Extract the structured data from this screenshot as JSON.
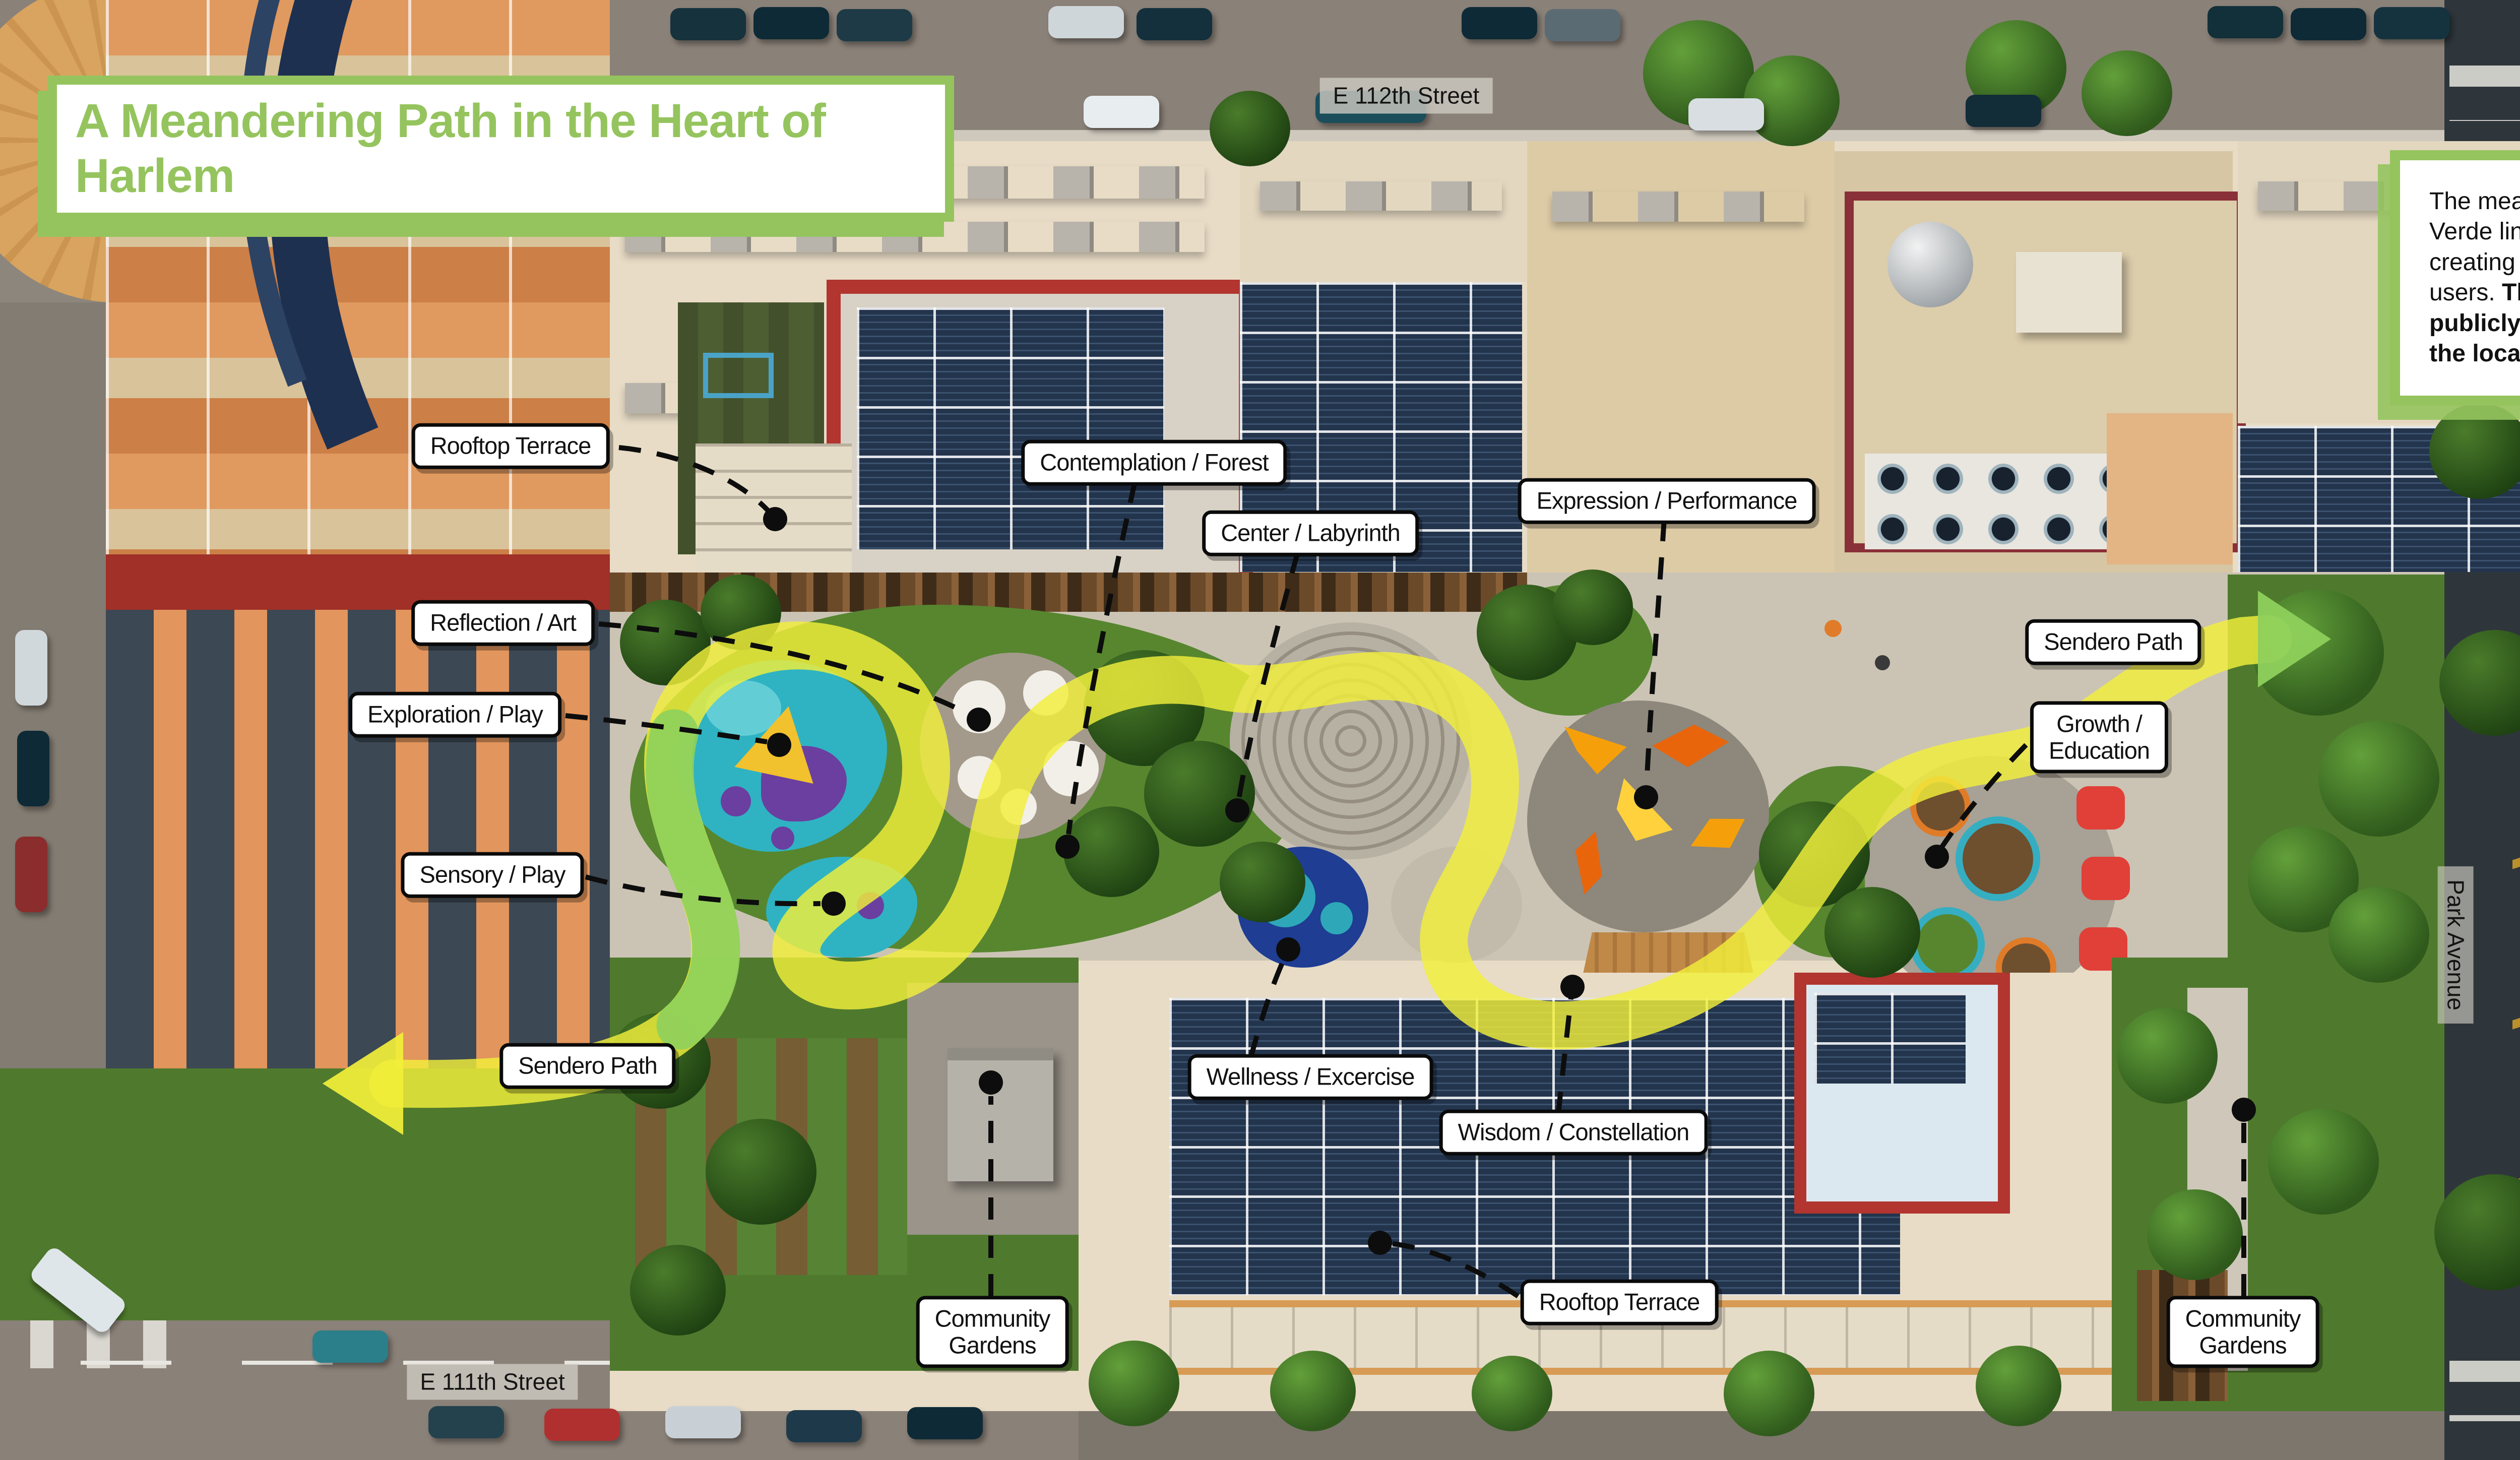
{
  "colors": {
    "accent_green": "#95c45e",
    "path_yellow": "#f2ef3a",
    "path_green": "#8ed05c",
    "label_border": "#0a0a0a"
  },
  "title": {
    "text": "A Meandering Path in the Heart of Harlem"
  },
  "description": {
    "intro": "The meandering pathway of Sendero Verde links diverse program features, creating spaces that cater to all types of users. ",
    "bold": "The elevated courtyard is publicly accessible for residents and the local community year-round!"
  },
  "streets": {
    "top": "E 112th Street",
    "bottom": "E 111th Street",
    "park_avenue": "Park Avenue",
    "railroad": "Long Island\nRail Road"
  },
  "compass": {
    "north_label": "N"
  },
  "feature_labels": [
    {
      "id": "rooftop-terrace-top",
      "text": "Rooftop Terrace"
    },
    {
      "id": "contemplation-forest",
      "text": "Contemplation / Forest"
    },
    {
      "id": "center-labyrinth",
      "text": "Center / Labyrinth"
    },
    {
      "id": "expression-performance",
      "text": "Expression / Performance"
    },
    {
      "id": "reflection-art",
      "text": "Reflection / Art"
    },
    {
      "id": "exploration-play",
      "text": "Exploration / Play"
    },
    {
      "id": "sensory-play",
      "text": "Sensory / Play"
    },
    {
      "id": "sendero-path-right",
      "text": "Sendero Path"
    },
    {
      "id": "growth-education",
      "text": "Growth /\nEducation"
    },
    {
      "id": "sendero-path-left",
      "text": "Sendero Path"
    },
    {
      "id": "wellness-excercise",
      "text": "Wellness / Excercise"
    },
    {
      "id": "wisdom-constellation",
      "text": "Wisdom / Constellation"
    },
    {
      "id": "rooftop-terrace-bottom",
      "text": "Rooftop Terrace"
    },
    {
      "id": "community-gardens-left",
      "text": "Community\nGardens"
    },
    {
      "id": "community-gardens-right",
      "text": "Community\nGardens"
    }
  ]
}
